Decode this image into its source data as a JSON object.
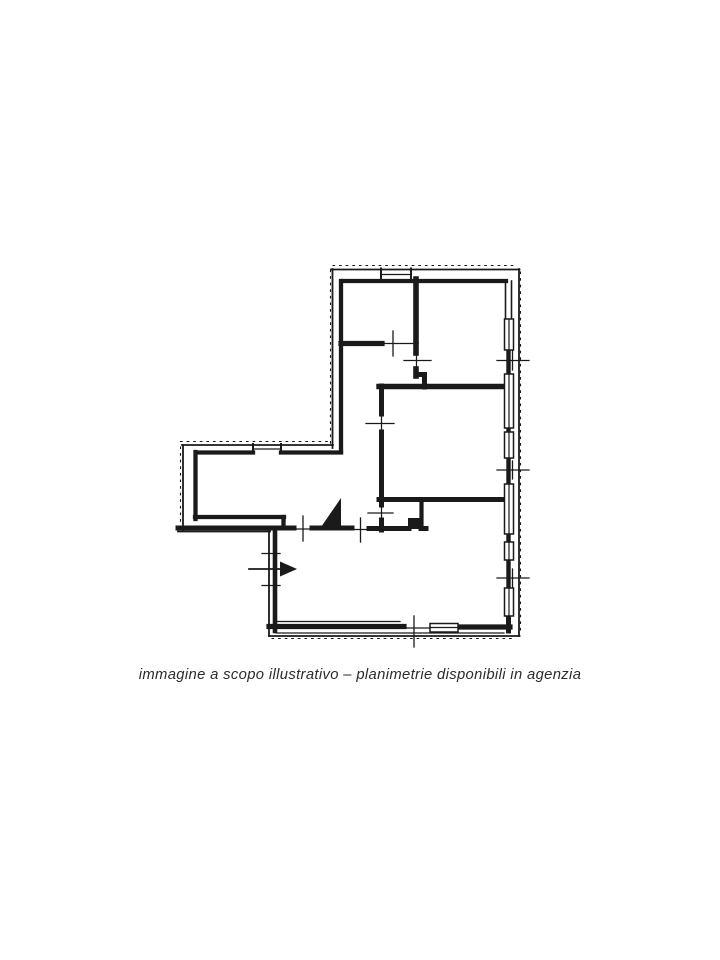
{
  "page": {
    "background": "#ffffff"
  },
  "caption": {
    "text": "immagine a scopo illustrativo – planimetrie disponibili in agenzia",
    "color": "#2b2b2b"
  },
  "floor_plan": {
    "ink": "#1a1a1a",
    "paper": "#ffffff",
    "walls": [
      {
        "d": "M333,265.5 H517",
        "w": 1.1,
        "da": "1.6 5"
      },
      {
        "d": "M330.5,270 V444",
        "w": 1.1,
        "da": "1.6 5"
      },
      {
        "d": "M520.5,272 V633",
        "w": 1.1,
        "da": "1.6 5"
      },
      {
        "d": "M272,638.5 H514",
        "w": 1.1,
        "da": "1.6 5"
      },
      {
        "d": "M180.5,441.5 H330",
        "w": 1.1,
        "da": "1.6 5"
      },
      {
        "d": "M180.5,447 V529",
        "w": 1.1,
        "da": "1.6 5"
      },
      {
        "d": "M331,269.5 H519.5",
        "w": 1.8
      },
      {
        "d": "M332.5,269 V448",
        "w": 1.8
      },
      {
        "d": "M519,269 V636",
        "w": 1.8
      },
      {
        "d": "M269,636 H519.5",
        "w": 1.8
      },
      {
        "d": "M182,445 H333",
        "w": 1.8
      },
      {
        "d": "M183,445 V531",
        "w": 1.8
      },
      {
        "d": "M178,531.5 H270",
        "w": 1.8
      },
      {
        "d": "M269,530 V636",
        "w": 1.8
      },
      {
        "d": "M343,281 H506",
        "w": 4.3
      },
      {
        "d": "M341,281 V452",
        "w": 4.3
      },
      {
        "d": "M197,452.5 H253",
        "w": 4.3
      },
      {
        "d": "M281,452.5 H341",
        "w": 4.3
      },
      {
        "d": "M195.5,452 V519",
        "w": 4.3
      },
      {
        "d": "M195,517 H284",
        "w": 4.3
      },
      {
        "d": "M283.5,517 V528",
        "w": 4.3
      },
      {
        "d": "M178,528 H294",
        "w": 5
      },
      {
        "d": "M312,528 H352",
        "w": 5
      },
      {
        "d": "M369,528.5 H409",
        "w": 5
      },
      {
        "d": "M421,528.5 H426",
        "w": 5
      },
      {
        "d": "M275,530 V631",
        "w": 4.6
      },
      {
        "d": "M269,626.5 H404",
        "w": 5.2
      },
      {
        "d": "M457,627 H510",
        "w": 5.2
      },
      {
        "d": "M508.5,350 V375",
        "w": 4.4
      },
      {
        "d": "M508.5,427 V433",
        "w": 4.4
      },
      {
        "d": "M508.5,458 V485",
        "w": 4.4
      },
      {
        "d": "M508.5,534 V542.5",
        "w": 4.4
      },
      {
        "d": "M508.5,559.5 V589",
        "w": 4.4
      },
      {
        "d": "M508.5,615.5 V631",
        "w": 5
      },
      {
        "d": "M505.5,281 V319",
        "w": 1.6
      },
      {
        "d": "M511.5,281 V319",
        "w": 1.6
      },
      {
        "d": "M416,279 V341",
        "w": 5.6
      },
      {
        "d": "M416,345 V353",
        "w": 5.6
      },
      {
        "d": "M416,369 V376",
        "w": 5.6
      },
      {
        "d": "M416,374.5 H424",
        "w": 5
      },
      {
        "d": "M424.5,374.5 V387",
        "w": 5
      },
      {
        "d": "M341,343.5 H382",
        "w": 5.2
      },
      {
        "d": "M379,386.5 H506",
        "w": 5.4
      },
      {
        "d": "M381.5,386 V414",
        "w": 5
      },
      {
        "d": "M381.5,432 V505",
        "w": 5
      },
      {
        "d": "M381.5,520 V530",
        "w": 5
      },
      {
        "d": "M379,499.5 H506",
        "w": 5
      },
      {
        "d": "M421.5,503 V528",
        "w": 4.2
      },
      {
        "d": "M320,528.5 L341,528.5 L341,498 Z",
        "f": "i"
      },
      {
        "d": "M408,518 h13 v11 h-13 Z",
        "f": "i"
      }
    ],
    "windows": [
      {
        "d": "M504.5,319 h9 v31 h-9 Z",
        "w": 1.5,
        "f": "w"
      },
      {
        "d": "M504.5,374 h9 v54 h-9 Z",
        "w": 1.5,
        "f": "w"
      },
      {
        "d": "M504.5,432 h9 v26 h-9 Z",
        "w": 1.5,
        "f": "w"
      },
      {
        "d": "M504.5,484 h9 v50 h-9 Z",
        "w": 1.5,
        "f": "w"
      },
      {
        "d": "M504.5,542 h9 v18 h-9 Z",
        "w": 1.5,
        "f": "w"
      },
      {
        "d": "M504.5,588 h9 v28 h-9 Z",
        "w": 1.5,
        "f": "w"
      },
      {
        "d": "M430,623.5 h28 v8.5 h-28 Z",
        "w": 1.5,
        "f": "w"
      },
      {
        "d": "M509,319 V350",
        "w": 1.2
      },
      {
        "d": "M509,374 V428",
        "w": 1.2
      },
      {
        "d": "M509,432 V458",
        "w": 1.2
      },
      {
        "d": "M509,484 V534",
        "w": 1.2
      },
      {
        "d": "M509,542 V560",
        "w": 1.2
      },
      {
        "d": "M509,588 V616",
        "w": 1.2
      },
      {
        "d": "M430,627.5 H458",
        "w": 1.2
      },
      {
        "d": "M381,274.5 H411",
        "w": 1.3
      },
      {
        "d": "M381,268.5 V278",
        "w": 2
      },
      {
        "d": "M411,268.5 V278",
        "w": 2
      },
      {
        "d": "M253,449 H281",
        "w": 1.3
      },
      {
        "d": "M253,444 V453.5",
        "w": 2
      },
      {
        "d": "M281,444 V453.5",
        "w": 2
      },
      {
        "d": "M276,621.5 H400",
        "w": 1.2
      },
      {
        "d": "M276,633 H504",
        "w": 1.3
      }
    ],
    "marks": [
      {
        "d": "M381,343.5 H414",
        "w": 1.25
      },
      {
        "d": "M416.5,353 V369",
        "w": 1.25
      },
      {
        "d": "M381.5,414 V432",
        "w": 1.25
      },
      {
        "d": "M381.5,505 V520",
        "w": 1.25
      },
      {
        "d": "M294,529 H312",
        "w": 1.25
      },
      {
        "d": "M352,529.5 H369",
        "w": 1.25
      },
      {
        "d": "M404,628 H430",
        "w": 1.25
      },
      {
        "d": "M393,331 V356",
        "w": 1.3
      },
      {
        "d": "M404,360.5 H431",
        "w": 1.3
      },
      {
        "d": "M497,360.5 H529",
        "w": 1.3
      },
      {
        "d": "M512.5,351 V370",
        "w": 1.3
      },
      {
        "d": "M366,423.5 H394",
        "w": 1.3
      },
      {
        "d": "M497,470 H529",
        "w": 1.3
      },
      {
        "d": "M512.5,461 V479",
        "w": 1.3
      },
      {
        "d": "M497,578 H529",
        "w": 1.3
      },
      {
        "d": "M512.5,569 V587",
        "w": 1.3
      },
      {
        "d": "M303,516 V541",
        "w": 1.3
      },
      {
        "d": "M360.5,518 V542",
        "w": 1.3
      },
      {
        "d": "M414,616 V647",
        "w": 1.3
      },
      {
        "d": "M262,553.5 H280",
        "w": 1.3
      },
      {
        "d": "M262,585.5 H280",
        "w": 1.3
      },
      {
        "d": "M368,513 H393",
        "w": 1.3
      }
    ],
    "arrow": [
      {
        "d": "M249,569 H283",
        "w": 1.7
      },
      {
        "d": "M297,569 L280,561.5 L280,576.5 Z",
        "f": "i"
      }
    ]
  }
}
